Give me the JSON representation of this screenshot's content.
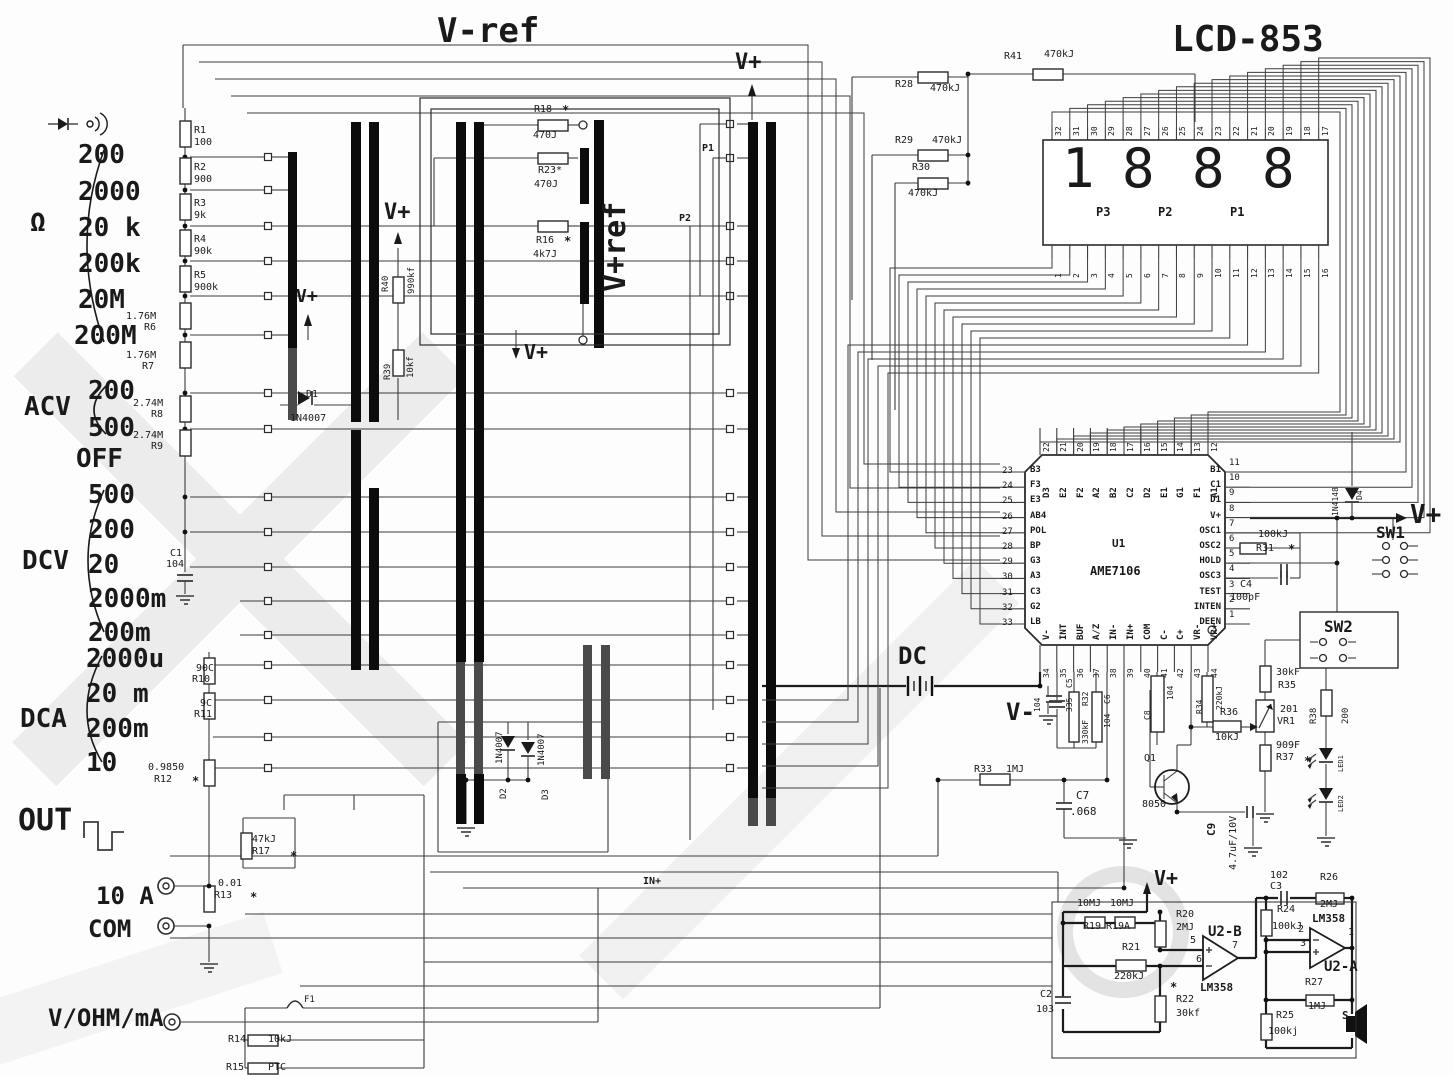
{
  "title": "Digital multimeter schematic",
  "selector": {
    "ohm_symbol": "Ω",
    "ohm_ranges": [
      "200",
      "2000",
      "20 k",
      "200k",
      "20M",
      "200M"
    ],
    "acv_label": "ACV",
    "acv_ranges": [
      "200",
      "500"
    ],
    "off_label": "OFF",
    "dcv_label": "DCV",
    "dcv_ranges": [
      "500",
      "200",
      "20",
      "2000m",
      "200m"
    ],
    "dca_label": "DCA",
    "dca_ranges": [
      "2000u",
      "20 m",
      "200m",
      "10"
    ],
    "out_label": "OUT",
    "jack_10a": "10 A",
    "jack_com": "COM",
    "jack_vohmma": "V/OHM/mA"
  },
  "power": {
    "vplus": "V+",
    "vminus": "V-",
    "vref_neg": "V-ref",
    "vref_pos": "V+ref",
    "dc": "DC",
    "in_plus": "IN+"
  },
  "connector": {
    "p1": "P1",
    "p2": "P2"
  },
  "switches": {
    "sw1": "SW1",
    "sw2": "SW2"
  },
  "lcd": {
    "model": "LCD-853",
    "digits": [
      "1",
      "8",
      "8",
      "8"
    ],
    "decimal_points": [
      "P3",
      "P2",
      "P1"
    ],
    "top_pins": [
      "32",
      "31",
      "30",
      "29",
      "28",
      "27",
      "26",
      "25",
      "24",
      "23",
      "22",
      "21",
      "20",
      "19",
      "18",
      "17"
    ],
    "bottom_pins": [
      "1",
      "2",
      "3",
      "4",
      "5",
      "6",
      "7",
      "8",
      "9",
      "10",
      "11",
      "12",
      "13",
      "14",
      "15",
      "16"
    ]
  },
  "ic": {
    "ref": "U1",
    "part": "AME7106",
    "pins": {
      "top": {
        "numbers": [
          "22",
          "21",
          "20",
          "19",
          "18",
          "17",
          "16",
          "15",
          "14",
          "13",
          "12"
        ],
        "labels": [
          "D3",
          "E2",
          "F2",
          "A2",
          "B2",
          "C2",
          "D2",
          "E1",
          "G1",
          "F1",
          "A1"
        ]
      },
      "left": {
        "numbers": [
          "23",
          "24",
          "25",
          "26",
          "27",
          "28",
          "29",
          "30",
          "31",
          "32",
          "33"
        ],
        "labels": [
          "B3",
          "F3",
          "E3",
          "AB4",
          "POL",
          "BP",
          "G3",
          "A3",
          "C3",
          "G2",
          "LB"
        ]
      },
      "right": {
        "numbers": [
          "11",
          "10",
          "9",
          "8",
          "7",
          "6",
          "5",
          "4",
          "3",
          "2",
          "1"
        ],
        "labels": [
          "B1",
          "C1",
          "D1",
          "V+",
          "OSC1",
          "OSC2",
          "HOLD",
          "OSC3",
          "TEST",
          "INTEN",
          "DEEN"
        ]
      },
      "bottom": {
        "numbers": [
          "34",
          "35",
          "36",
          "37",
          "38",
          "39",
          "40",
          "41",
          "42",
          "43",
          "44"
        ],
        "labels": [
          "V-",
          "INT",
          "BUF",
          "A/Z",
          "IN-",
          "IN+",
          "COM",
          "C-",
          "C+",
          "VR-",
          "VR+"
        ]
      }
    }
  },
  "amps": {
    "u2a": "U2-A",
    "u2b": "U2-B",
    "chip": "LM358",
    "u2b_pins": [
      "5",
      "6",
      "7"
    ],
    "u2a_pins": [
      "2",
      "3",
      "1"
    ],
    "speaker": "S"
  },
  "components": {
    "r1": {
      "n": "R1",
      "v": "100"
    },
    "r2": {
      "n": "R2",
      "v": "900"
    },
    "r3": {
      "n": "R3",
      "v": "9k"
    },
    "r4": {
      "n": "R4",
      "v": "90k"
    },
    "r5": {
      "n": "R5",
      "v": "900k"
    },
    "r6": {
      "n": "R6",
      "v": "1.76M"
    },
    "r7": {
      "n": "R7",
      "v": "1.76M"
    },
    "r8": {
      "n": "R8",
      "v": "2.74M"
    },
    "r9": {
      "n": "R9",
      "v": "2.74M"
    },
    "r10": {
      "n": "R10",
      "v": "90C"
    },
    "r11": {
      "n": "R11",
      "v": "9C"
    },
    "r12": {
      "n": "R12",
      "v": "0.9850",
      "s": "*"
    },
    "r13": {
      "n": "R13",
      "v": "0.01",
      "s": "*"
    },
    "r14": {
      "n": "R14",
      "v": "10kJ"
    },
    "r15": {
      "n": "R15",
      "v": "PTC"
    },
    "r16": {
      "n": "R16",
      "v": "4k7J",
      "s": "*"
    },
    "r17": {
      "n": "R17",
      "v": "47kJ",
      "s": "*"
    },
    "r18": {
      "n": "R18",
      "v": "470J",
      "s": "*"
    },
    "r19": {
      "n": "R19",
      "v": "10MJ"
    },
    "r19a": {
      "n": "R19A",
      "v": "10MJ"
    },
    "r20": {
      "n": "R20",
      "v": "2MJ"
    },
    "r21": {
      "n": "R21",
      "v": "220kJ"
    },
    "r22": {
      "n": "R22",
      "v": "30kf",
      "s": "*"
    },
    "r23": {
      "n": "R23*",
      "v": "470J"
    },
    "r24": {
      "n": "R24",
      "v": "100kJ"
    },
    "r25": {
      "n": "R25",
      "v": "100kj"
    },
    "r26": {
      "n": "R26",
      "v": "2MJ"
    },
    "r27": {
      "n": "R27",
      "v": "1MJ"
    },
    "r28": {
      "n": "R28",
      "v": "470kJ"
    },
    "r29": {
      "n": "R29",
      "v": "470kJ"
    },
    "r30": {
      "n": "R30",
      "v": "470kJ"
    },
    "r31": {
      "n": "R31",
      "v": "100kJ",
      "s": "*"
    },
    "r32": {
      "n": "R32",
      "v": "330kF"
    },
    "r33": {
      "n": "R33",
      "v": "1MJ"
    },
    "r34": {
      "n": "R34",
      "v": "220kJ"
    },
    "r35": {
      "n": "R35",
      "v": "30kF"
    },
    "r36": {
      "n": "R36",
      "v": "10kJ"
    },
    "r37": {
      "n": "R37",
      "v": "909F",
      "s": "*"
    },
    "r38": {
      "n": "R38",
      "v": "200"
    },
    "r39": {
      "n": "R39",
      "v": "10kf"
    },
    "r40": {
      "n": "R40",
      "v": "990kf"
    },
    "r41": {
      "n": "R41",
      "v": "470kJ"
    },
    "c1": {
      "n": "C1",
      "v": "104"
    },
    "c2": {
      "n": "C2",
      "v": "103"
    },
    "c3": {
      "n": "C3",
      "v": "102"
    },
    "c4": {
      "n": "C4",
      "v": "100pF"
    },
    "c5": {
      "n": "C5",
      "v": "335"
    },
    "c6": {
      "n": "C6",
      "v": "104"
    },
    "c7": {
      "n": "C7",
      "v": ".068"
    },
    "c8": {
      "n": "C8",
      "v": "104"
    },
    "c9": {
      "n": "C9",
      "v": "4.7uF/10V"
    },
    "cv": {
      "n": "",
      "v": "104"
    },
    "d1": {
      "n": "D1",
      "v": "1N4007"
    },
    "d2": {
      "n": "D2",
      "v": "1N4007"
    },
    "d3": {
      "n": "D3",
      "v": "1N4007"
    },
    "d4": {
      "n": "D4",
      "v": "1N4148"
    },
    "q1": {
      "n": "Q1",
      "v": "8050"
    },
    "vr1": {
      "n": "VR1",
      "v": "201"
    },
    "f1": {
      "n": "F1"
    },
    "led1": {
      "n": "LED1"
    },
    "led2": {
      "n": "LED2"
    }
  }
}
